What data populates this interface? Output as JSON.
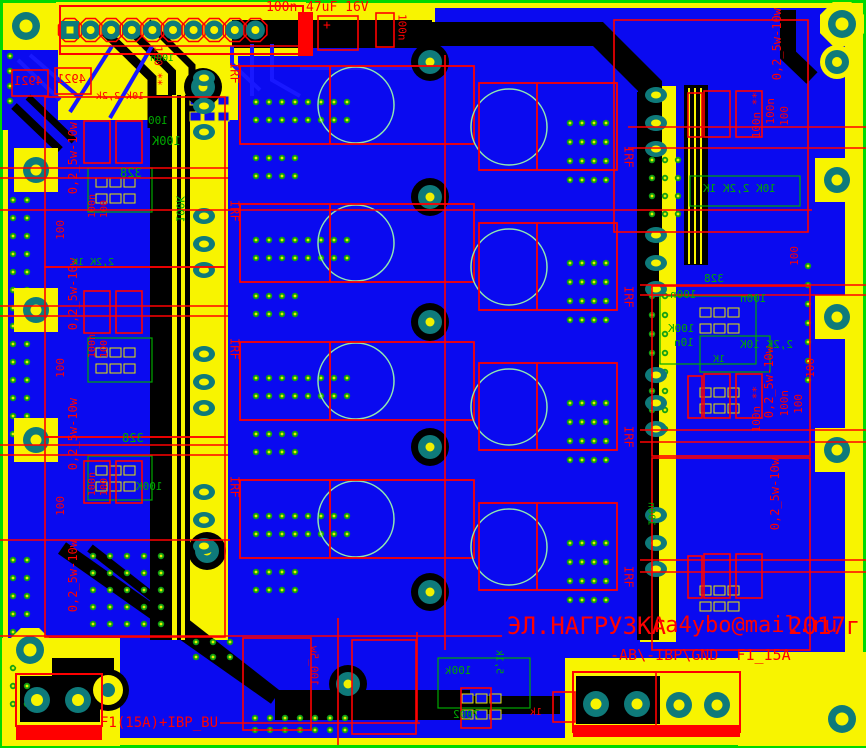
{
  "colors": {
    "edge": "#00d800",
    "pour": "#f8f400",
    "board": "#0a0af0",
    "black": "#000000",
    "silk_red": "#ff0000",
    "silk_green": "#00a800",
    "pad_ring": "#0e7a7a",
    "pad_center": "#f8f400",
    "via_ring": "#12a012",
    "via_center": "#e8f000",
    "hole_circle": "#8fe8b0",
    "trace_blue": "#1818ff"
  },
  "board_text": {
    "project_title": "ЭЛ.НАГРУЗКА",
    "author_email": "ra4ybo@mail.ru",
    "year": "2017г",
    "power_connector_label": "-АВ\\-IBP\\GND  F1_15A",
    "fuse_label": "F1(15A)+IBP_BU",
    "mosfet_ref": "IRF",
    "shunt_resistor_value": "0,2_5w-10w"
  },
  "silkscreen_labels": [
    {
      "t": "100n",
      "x": 266,
      "y": 2,
      "d": "h",
      "c": "r",
      "s": 13
    },
    {
      "t": "47uF 16V",
      "x": 306,
      "y": 2,
      "d": "h",
      "c": "r",
      "s": 13
    },
    {
      "t": "+",
      "x": 323,
      "y": 20,
      "d": "h",
      "c": "r",
      "s": 13
    },
    {
      "t": "100n",
      "x": 396,
      "y": 14,
      "d": "vd",
      "c": "r",
      "s": 11
    },
    {
      "t": "100 **",
      "x": 152,
      "y": 46,
      "d": "vd",
      "c": "r",
      "s": 11
    },
    {
      "t": "IRF",
      "x": 228,
      "y": 62,
      "d": "vd",
      "c": "r",
      "s": 12,
      "name": "mosfet-ref-label"
    },
    {
      "t": "IRF",
      "x": 228,
      "y": 200,
      "d": "vd",
      "c": "r",
      "s": 12,
      "name": "mosfet-ref-label"
    },
    {
      "t": "IRF",
      "x": 228,
      "y": 338,
      "d": "vd",
      "c": "r",
      "s": 12,
      "name": "mosfet-ref-label"
    },
    {
      "t": "IRF",
      "x": 228,
      "y": 476,
      "d": "vd",
      "c": "r",
      "s": 12,
      "name": "mosfet-ref-label"
    },
    {
      "t": "IRF",
      "x": 622,
      "y": 146,
      "d": "vd",
      "c": "r",
      "s": 12,
      "name": "mosfet-ref-label"
    },
    {
      "t": "IRF",
      "x": 622,
      "y": 286,
      "d": "vd",
      "c": "r",
      "s": 12,
      "name": "mosfet-ref-label"
    },
    {
      "t": "IRF",
      "x": 622,
      "y": 426,
      "d": "vd",
      "c": "r",
      "s": 12,
      "name": "mosfet-ref-label"
    },
    {
      "t": "IRF",
      "x": 622,
      "y": 566,
      "d": "vd",
      "c": "r",
      "s": 12,
      "name": "mosfet-ref-label"
    },
    {
      "t": "0,2_5w-10w",
      "x": 68,
      "y": 122,
      "d": "vu",
      "c": "r",
      "s": 12,
      "name": "shunt-label"
    },
    {
      "t": "0,2_5w-10w",
      "x": 68,
      "y": 258,
      "d": "vu",
      "c": "r",
      "s": 12,
      "name": "shunt-label"
    },
    {
      "t": "0,2_5w-10w",
      "x": 68,
      "y": 398,
      "d": "vu",
      "c": "r",
      "s": 12,
      "name": "shunt-label"
    },
    {
      "t": "0,2_5w-10w",
      "x": 68,
      "y": 540,
      "d": "vu",
      "c": "r",
      "s": 12,
      "name": "shunt-label"
    },
    {
      "t": "0,2_5w-10w",
      "x": 772,
      "y": 8,
      "d": "vu",
      "c": "r",
      "s": 12,
      "name": "shunt-label"
    },
    {
      "t": "0,2_5w-10w",
      "x": 764,
      "y": 346,
      "d": "vu",
      "c": "r",
      "s": 12,
      "name": "shunt-label"
    },
    {
      "t": "0,2_5w-10w",
      "x": 770,
      "y": 458,
      "d": "vu",
      "c": "r",
      "s": 12,
      "name": "shunt-label"
    },
    {
      "t": "100n **",
      "x": 752,
      "y": 92,
      "d": "vu",
      "c": "r",
      "s": 11
    },
    {
      "t": "100n",
      "x": 766,
      "y": 98,
      "d": "vu",
      "c": "r",
      "s": 11
    },
    {
      "t": "100",
      "x": 780,
      "y": 106,
      "d": "vu",
      "c": "r",
      "s": 11
    },
    {
      "t": "100n **",
      "x": 752,
      "y": 386,
      "d": "vu",
      "c": "r",
      "s": 11
    },
    {
      "t": "100n",
      "x": 780,
      "y": 390,
      "d": "vu",
      "c": "r",
      "s": 11
    },
    {
      "t": "100",
      "x": 794,
      "y": 394,
      "d": "vu",
      "c": "r",
      "s": 11
    },
    {
      "t": "100",
      "x": 806,
      "y": 358,
      "d": "vu",
      "c": "r",
      "s": 11
    },
    {
      "t": "100",
      "x": 790,
      "y": 246,
      "d": "vu",
      "c": "r",
      "s": 11
    },
    {
      "t": "100",
      "x": 56,
      "y": 220,
      "d": "vu",
      "c": "r",
      "s": 11
    },
    {
      "t": "100",
      "x": 56,
      "y": 358,
      "d": "vu",
      "c": "r",
      "s": 11
    },
    {
      "t": "100",
      "x": 56,
      "y": 496,
      "d": "vu",
      "c": "r",
      "s": 11
    },
    {
      "t": "100n",
      "x": 88,
      "y": 194,
      "d": "vu",
      "c": "r",
      "s": 10
    },
    {
      "t": "100",
      "x": 100,
      "y": 200,
      "d": "vu",
      "c": "r",
      "s": 10
    },
    {
      "t": "100n",
      "x": 88,
      "y": 334,
      "d": "vu",
      "c": "r",
      "s": 10
    },
    {
      "t": "100",
      "x": 100,
      "y": 340,
      "d": "vu",
      "c": "r",
      "s": 10
    },
    {
      "t": "100n",
      "x": 88,
      "y": 472,
      "d": "vu",
      "c": "r",
      "s": 10
    },
    {
      "t": "100",
      "x": 100,
      "y": 478,
      "d": "vu",
      "c": "r",
      "s": 10
    },
    {
      "t": "ЭЛ.НАГРУЗКА",
      "x": 507,
      "y": 615,
      "d": "h",
      "c": "r",
      "s": 24,
      "name": "board-title-text"
    },
    {
      "t": "ra4ybo@mail.ru",
      "x": 652,
      "y": 616,
      "d": "h",
      "c": "r",
      "s": 22,
      "name": "author-email-text"
    },
    {
      "t": "2017г",
      "x": 788,
      "y": 615,
      "d": "h",
      "c": "r",
      "s": 24,
      "name": "year-text"
    },
    {
      "t": "-АВ\\-IBP\\GND  F1_15A",
      "x": 610,
      "y": 648,
      "d": "h",
      "c": "r",
      "s": 15,
      "name": "power-connector-label"
    },
    {
      "t": "F1(15A)+IBP_BU",
      "x": 100,
      "y": 717,
      "d": "h",
      "c": "r",
      "s": 14,
      "name": "fuse-label"
    },
    {
      "t": "4921",
      "x": 14,
      "y": 76,
      "d": "h",
      "c": "r",
      "s": 12,
      "m": true
    },
    {
      "t": "4921",
      "x": 57,
      "y": 74,
      "d": "h",
      "c": "r",
      "s": 12,
      "m": true
    },
    {
      "t": "10k 2,2k",
      "x": 96,
      "y": 92,
      "d": "h",
      "c": "r",
      "s": 10,
      "m": true
    },
    {
      "t": "100_5w",
      "x": 308,
      "y": 646,
      "d": "vu",
      "c": "r",
      "s": 11,
      "m": true
    },
    {
      "t": "1k",
      "x": 530,
      "y": 708,
      "d": "h",
      "c": "r",
      "s": 10,
      "m": true
    },
    {
      "t": "100",
      "x": 148,
      "y": 116,
      "d": "h",
      "c": "g",
      "s": 11,
      "m": true
    },
    {
      "t": "100K",
      "x": 152,
      "y": 136,
      "d": "h",
      "c": "g",
      "s": 12,
      "m": true
    },
    {
      "t": "328",
      "x": 120,
      "y": 168,
      "d": "h",
      "c": "g",
      "s": 12,
      "m": true
    },
    {
      "t": "328",
      "x": 122,
      "y": 433,
      "d": "h",
      "c": "g",
      "s": 12,
      "m": true
    },
    {
      "t": "328",
      "x": 704,
      "y": 274,
      "d": "h",
      "c": "g",
      "s": 11,
      "m": true
    },
    {
      "t": "100n",
      "x": 670,
      "y": 290,
      "d": "h",
      "c": "g",
      "s": 11,
      "m": true
    },
    {
      "t": "100n",
      "x": 740,
      "y": 294,
      "d": "h",
      "c": "g",
      "s": 11,
      "m": true
    },
    {
      "t": "100K",
      "x": 668,
      "y": 324,
      "d": "h",
      "c": "g",
      "s": 11,
      "m": true
    },
    {
      "t": "10n",
      "x": 674,
      "y": 338,
      "d": "h",
      "c": "g",
      "s": 11,
      "m": true
    },
    {
      "t": "10K 2,2K 1K",
      "x": 703,
      "y": 184,
      "d": "h",
      "c": "g",
      "s": 11,
      "m": true
    },
    {
      "t": "2,2K 10K",
      "x": 740,
      "y": 340,
      "d": "h",
      "c": "g",
      "s": 11,
      "m": true
    },
    {
      "t": "1K",
      "x": 713,
      "y": 355,
      "d": "h",
      "c": "g",
      "s": 10,
      "m": true
    },
    {
      "t": "100k",
      "x": 445,
      "y": 666,
      "d": "h",
      "c": "g",
      "s": 11,
      "m": true
    },
    {
      "t": "7002",
      "x": 453,
      "y": 710,
      "d": "h",
      "c": "g",
      "s": 11,
      "m": true
    },
    {
      "t": "5,1k",
      "x": 494,
      "y": 650,
      "d": "vu",
      "c": "g",
      "s": 10,
      "m": true
    },
    {
      "t": "2,2K 1K",
      "x": 72,
      "y": 258,
      "d": "h",
      "c": "g",
      "s": 10,
      "m": true
    },
    {
      "t": "100K",
      "x": 136,
      "y": 482,
      "d": "h",
      "c": "g",
      "s": 11,
      "m": true
    },
    {
      "t": "100K",
      "x": 174,
      "y": 196,
      "d": "vu",
      "c": "g",
      "s": 11,
      "m": true
    },
    {
      "t": "100n",
      "x": 646,
      "y": 502,
      "d": "vu",
      "c": "g",
      "s": 10,
      "m": true
    },
    {
      "t": "100n",
      "x": 150,
      "y": 54,
      "d": "h",
      "c": "g",
      "s": 10,
      "m": true
    }
  ]
}
